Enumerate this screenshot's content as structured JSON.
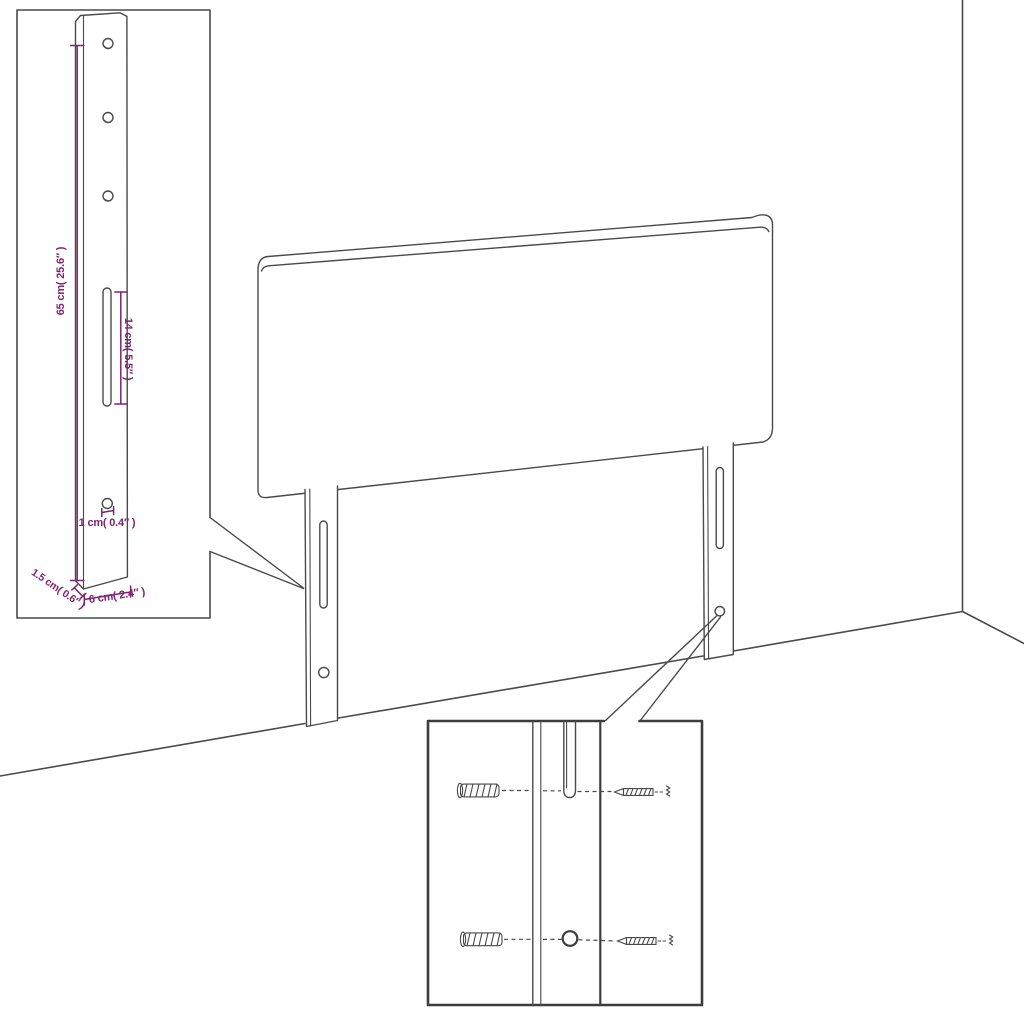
{
  "canvas": {
    "width": 1024,
    "height": 1024,
    "background": "#ffffff"
  },
  "colors": {
    "line": "#4a4a4a",
    "inset_border": "#3d3d3d",
    "dimension": "#7c2470"
  },
  "bracket_detail": {
    "dim_height": "65 cm( 25.6″ )",
    "dim_slot": "14 cm( 5.5″ )",
    "dim_hole": "1 cm( 0.4″ )",
    "dim_thickness": "1.5 cm( 0.6″ )",
    "dim_width": "6 cm( 2.4″ )"
  },
  "icons": {
    "wall_anchor": "wall-anchor-icon",
    "screw": "screw-icon"
  }
}
